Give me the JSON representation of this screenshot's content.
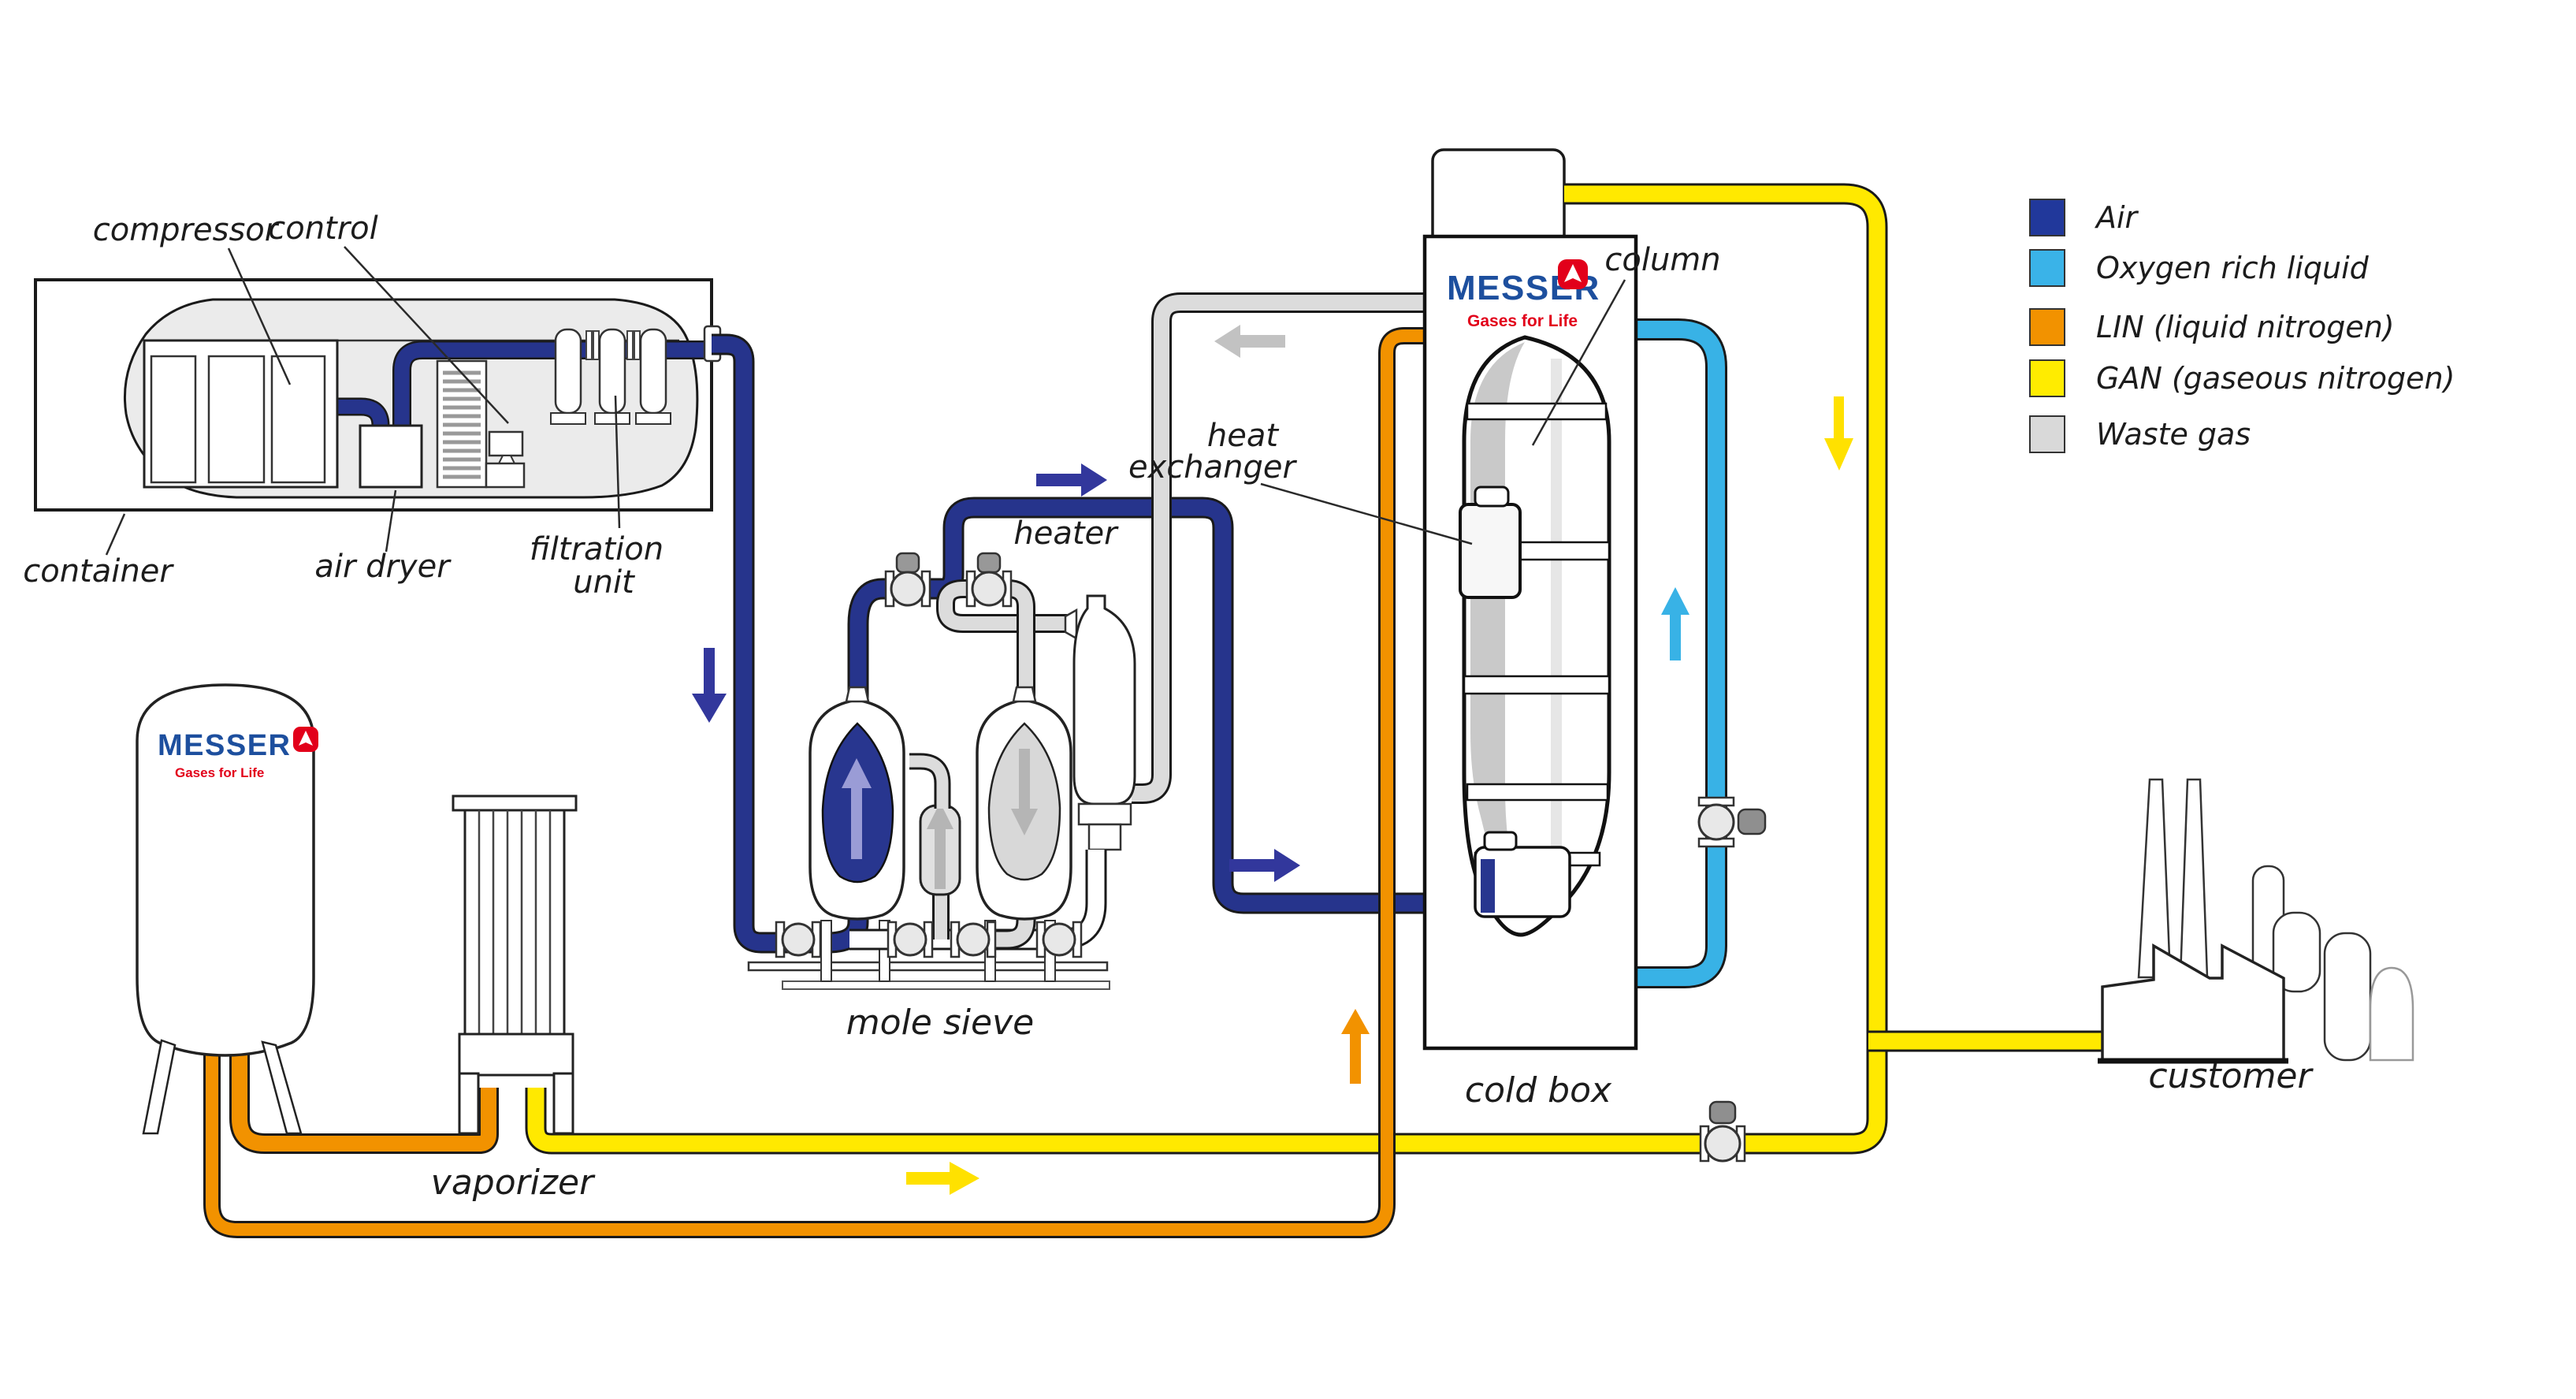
{
  "legend": {
    "items": [
      {
        "label": "Air",
        "color": "#21389b"
      },
      {
        "label": "Oxygen rich liquid",
        "color": "#3ab3e8"
      },
      {
        "label": "LIN (liquid nitrogen)",
        "color": "#f29200"
      },
      {
        "label": "GAN (gaseous nitrogen)",
        "color": "#ffec00"
      },
      {
        "label": "Waste gas",
        "color": "#d9d9d9"
      }
    ]
  },
  "labels": {
    "compressor": "compressor",
    "control": "control",
    "container": "container",
    "air_dryer": "air dryer",
    "filtration_line1": "filtration",
    "filtration_line2": "unit",
    "mole_sieve": "mole sieve",
    "heater": "heater",
    "heat_exchanger_line1": "heat",
    "heat_exchanger_line2": "exchanger",
    "column": "column",
    "cold_box": "cold box",
    "vaporizer": "vaporizer",
    "customer": "customer"
  },
  "brand": {
    "wordmark": "MESSER",
    "tagline": "Gases for Life"
  },
  "colors": {
    "air": "#26348c",
    "oxygen_rich_liquid": "#38b2e6",
    "lin": "#f29200",
    "gan": "#ffe900",
    "waste_gas": "#dcdcdc",
    "brand_blue": "#1d4f9e",
    "brand_red": "#e2001a",
    "outline": "#1a1a1a"
  }
}
